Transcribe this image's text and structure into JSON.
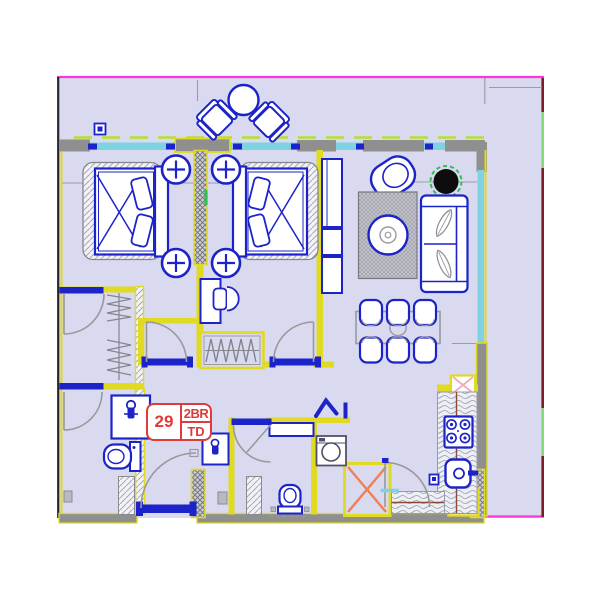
{
  "unit_label": {
    "number": "29",
    "type": "2BR",
    "suffix": "TD"
  },
  "colors": {
    "floor": "#d9d9f0",
    "wall_yellow": "#e0da20",
    "wall_gray": "#8f8f8f",
    "furniture_blue": "#1c23c8",
    "window_cyan": "#7fd2e2",
    "dash_green": "#b5e033",
    "border_magenta": "#f837d8",
    "border_dark_red": "#7e1f1f",
    "border_green": "#7fdd7f",
    "border_black": "#26262e",
    "label_red": "#e03a3a",
    "door_arc_gray": "#999999",
    "shaft_x_orange": "#ef8055",
    "shaft_x_pink": "#f2a9bc",
    "plant_black": "#0d0d0d",
    "plant_ring_green": "#2fbf4f",
    "counter_line_brown": "#8a4a3a"
  }
}
